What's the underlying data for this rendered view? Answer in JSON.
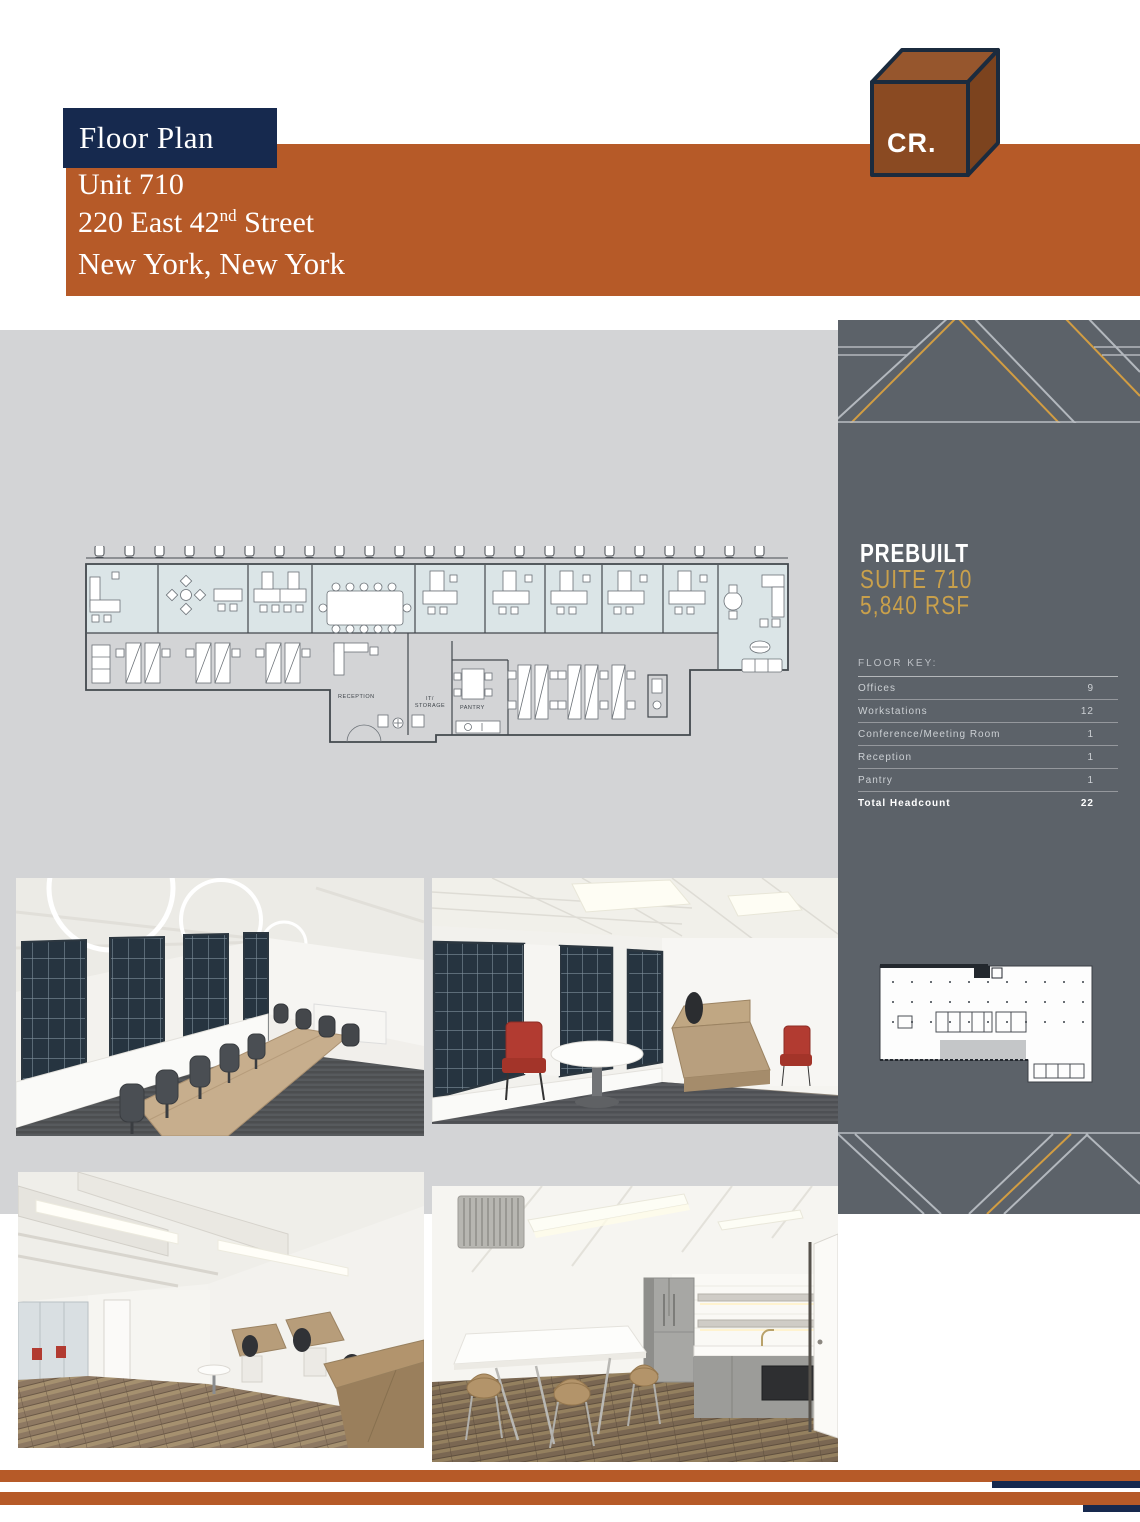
{
  "header": {
    "tag_label": "Floor Plan",
    "unit": "Unit 710",
    "address": {
      "pre": "220 East 42",
      "sup": "nd",
      "post": " Street"
    },
    "city": "New York, New York"
  },
  "logo": {
    "text": "CR."
  },
  "plan": {
    "reception": "RECEPTION",
    "it_line1": "IT/",
    "it_line2": "STORAGE",
    "pantry": "PANTRY"
  },
  "sidebar": {
    "title1": "PREBUILT",
    "title2": "SUITE 710",
    "title3": "5,840 RSF",
    "floor_key": "FLOOR KEY:",
    "rows": [
      {
        "label": "Offices",
        "value": "9"
      },
      {
        "label": "Workstations",
        "value": "12"
      },
      {
        "label": "Conference/Meeting Room",
        "value": "1"
      },
      {
        "label": "Reception",
        "value": "1"
      },
      {
        "label": "Pantry",
        "value": "1"
      }
    ],
    "total": {
      "label": "Total Headcount",
      "value": "22"
    }
  },
  "colors": {
    "orange": "#b65a28",
    "navy": "#16294e",
    "gold": "#d19d42",
    "sidebar_gray": "#5c6269",
    "panel_gray": "#d3d4d6",
    "plan_tint": "#dbe5e7"
  }
}
